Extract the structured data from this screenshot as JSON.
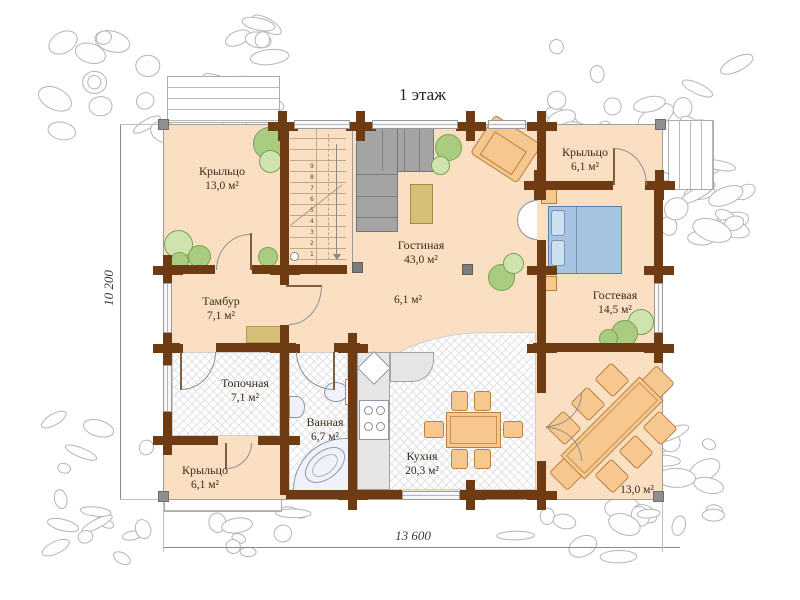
{
  "title": "1 этаж",
  "dimensions": {
    "bottom": "13 600",
    "left": "10 200"
  },
  "rooms": {
    "porch_top_left": {
      "name": "Крыльцо",
      "area": "13,0 м²"
    },
    "porch_top_right": {
      "name": "Крыльцо",
      "area": "6,1 м²"
    },
    "living": {
      "name": "Гостиная",
      "area": "43,0 м²"
    },
    "hall": {
      "area": "6,1 м²"
    },
    "guest": {
      "name": "Гостевая",
      "area": "14,5 м²"
    },
    "tambur": {
      "name": "Тамбур",
      "area": "7,1 м²"
    },
    "boiler": {
      "name": "Топочная",
      "area": "7,1 м²"
    },
    "bathroom": {
      "name": "Ванная",
      "area": "6,7 м²"
    },
    "kitchen": {
      "name": "Кухня",
      "area": "20,3 м²"
    },
    "porch_bottom_left": {
      "name": "Крыльцо",
      "area": "6,1 м²"
    },
    "terrace": {
      "area": "13,0 м²"
    }
  },
  "stairs": {
    "steps": [
      "1",
      "2",
      "3",
      "4",
      "5",
      "6",
      "7",
      "8",
      "9"
    ]
  },
  "colors": {
    "wall": "#6e3b12",
    "floor": "#fadfc3",
    "furniture_wood": "#f6c78e",
    "bed": "#a6c4e2",
    "plant": "#a9cc80",
    "rug": "#d8bf77",
    "sofa": "#a4a4a4",
    "stone_outline": "#b5b5b5"
  }
}
